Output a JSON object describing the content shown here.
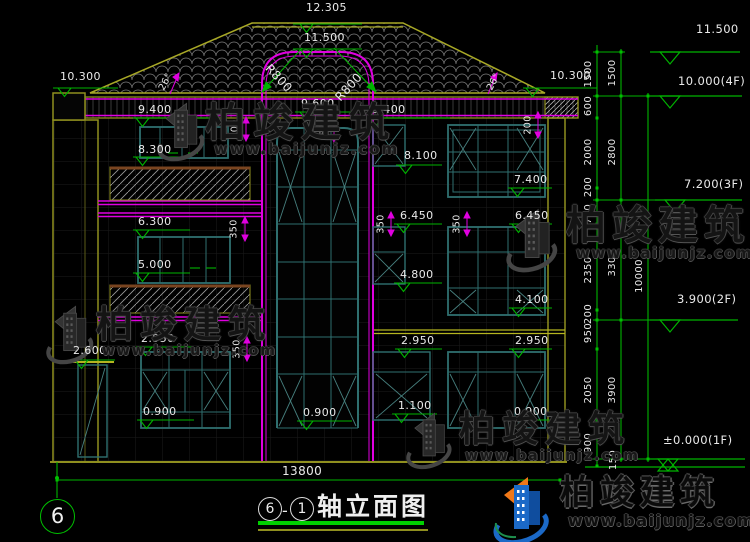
{
  "brand": {
    "name": "柏竣建筑",
    "url": "www.baijunjz.com"
  },
  "title": {
    "axis_a": "6",
    "sep": "-",
    "axis_b": "1",
    "label": "轴立面图"
  },
  "grid_bubble": {
    "label": "6"
  },
  "dims": {
    "overall_width": "13800"
  },
  "markers": [
    {
      "label": "10.300"
    },
    {
      "label": "12.305"
    },
    {
      "label": "11.500"
    },
    {
      "label": "9.400"
    },
    {
      "label": "9.600"
    },
    {
      "label": "9.400"
    },
    {
      "label": "10.300"
    },
    {
      "label": "8.300"
    },
    {
      "label": "8.100"
    },
    {
      "label": "7.400"
    },
    {
      "label": "6.300"
    },
    {
      "label": "6.450"
    },
    {
      "label": "6.450"
    },
    {
      "label": "5.000"
    },
    {
      "label": "4.800"
    },
    {
      "label": "4.100"
    },
    {
      "label": "2.950"
    },
    {
      "label": "2.600"
    },
    {
      "label": "2.950"
    },
    {
      "label": "2.950"
    },
    {
      "label": "1.100"
    },
    {
      "label": "0.900"
    },
    {
      "label": "0.900"
    },
    {
      "label": "0.900"
    }
  ],
  "levels": [
    {
      "label": "11.500"
    },
    {
      "label": "10.000(4F)"
    },
    {
      "label": "7.200(3F)"
    },
    {
      "label": "3.900(2F)"
    },
    {
      "label": "±0.000(1F)"
    }
  ],
  "chain_col1": [
    {
      "label": "1500"
    },
    {
      "label": "600"
    },
    {
      "label": "2000"
    },
    {
      "label": "200"
    },
    {
      "label": "750"
    },
    {
      "label": "2350"
    },
    {
      "label": "200"
    },
    {
      "label": "950"
    },
    {
      "label": "2050"
    },
    {
      "label": "900"
    },
    {
      "label": "150"
    }
  ],
  "chain_col2": [
    {
      "label": "1500"
    },
    {
      "label": "2800"
    },
    {
      "label": "3300"
    },
    {
      "label": "3900"
    }
  ],
  "chain_col3": [
    {
      "label": "10000"
    }
  ],
  "small_dims": [
    {
      "label": "200"
    },
    {
      "label": "200"
    },
    {
      "label": "550"
    },
    {
      "label": "350"
    },
    {
      "label": "350"
    },
    {
      "label": "350"
    },
    {
      "label": "350"
    }
  ],
  "angles": [
    {
      "label": "26°"
    },
    {
      "label": "26°"
    }
  ],
  "radii": [
    {
      "label": "R800"
    },
    {
      "label": "R800"
    }
  ],
  "colors": {
    "dim_green": "#00b400",
    "magenta": "#e000e0",
    "wall_olive": "#8f8f1f",
    "window_teal": "#2f6f6f",
    "title_green": "#00d000",
    "logo_blue": "#1b69c7",
    "logo_orange": "#f07818"
  }
}
